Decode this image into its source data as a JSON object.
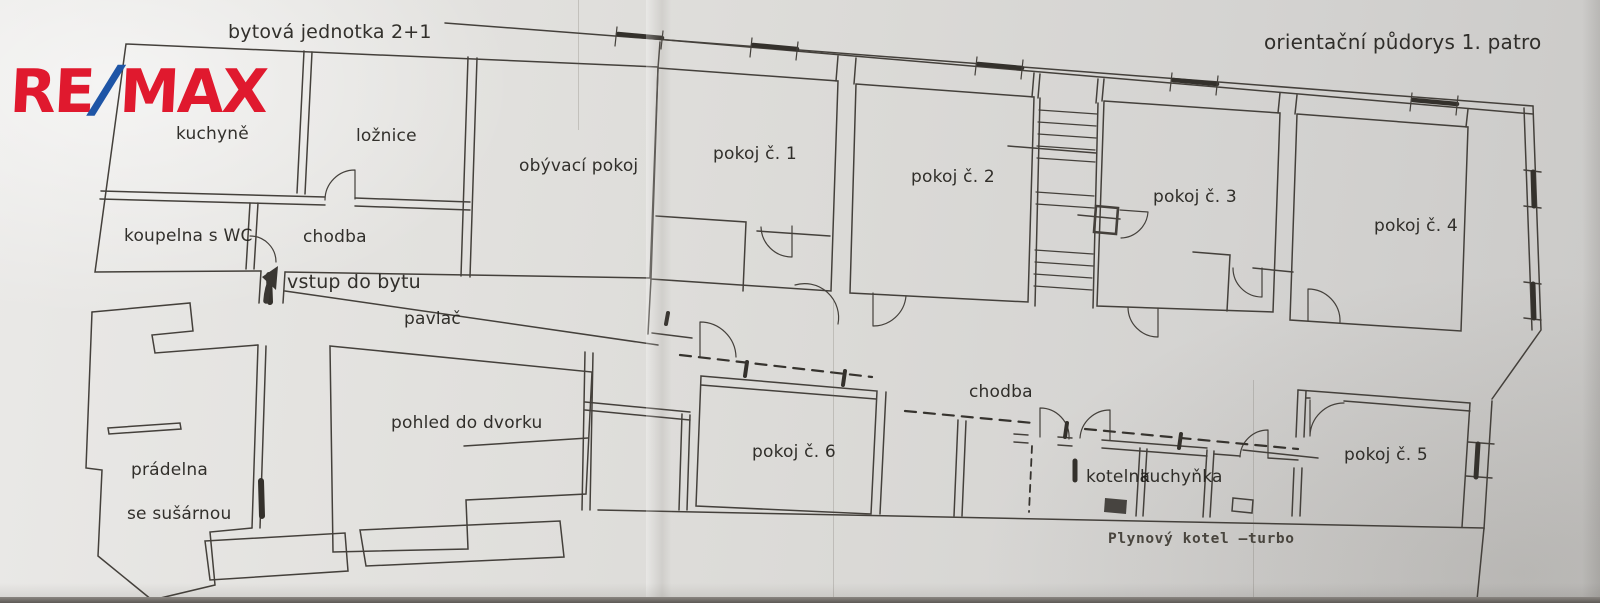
{
  "titles": {
    "left": "bytová jednotka 2+1",
    "right": "orientační půdorys 1. patro"
  },
  "logo": {
    "re": "RE",
    "slash": "/",
    "max": "MAX",
    "red": "#e0192e",
    "blue": "#1e55a6"
  },
  "rooms": {
    "kuchyne": "kuchyně",
    "loznice": "ložnice",
    "obyvaci": "obývací pokoj",
    "koupelna": "koupelna s WC",
    "chodba_byt": "chodba",
    "vstup": "vstup do bytu",
    "pavlac": "pavlač",
    "pohled": "pohled do dvorku",
    "pradelna": "prádelna",
    "susarna": "se sušárnou",
    "pokoj1": "pokoj č. 1",
    "pokoj2": "pokoj č. 2",
    "pokoj3": "pokoj č. 3",
    "pokoj4": "pokoj č. 4",
    "pokoj5": "pokoj č. 5",
    "pokoj6": "pokoj č. 6",
    "chodba_patro": "chodba",
    "kotelna": "kotelna",
    "kuchynka": "kuchyňka"
  },
  "annotations": {
    "plynovy_kotel": "Plynový kotel –turbo"
  },
  "colors": {
    "ink": "#44403b",
    "paper": "#dddcd9"
  }
}
